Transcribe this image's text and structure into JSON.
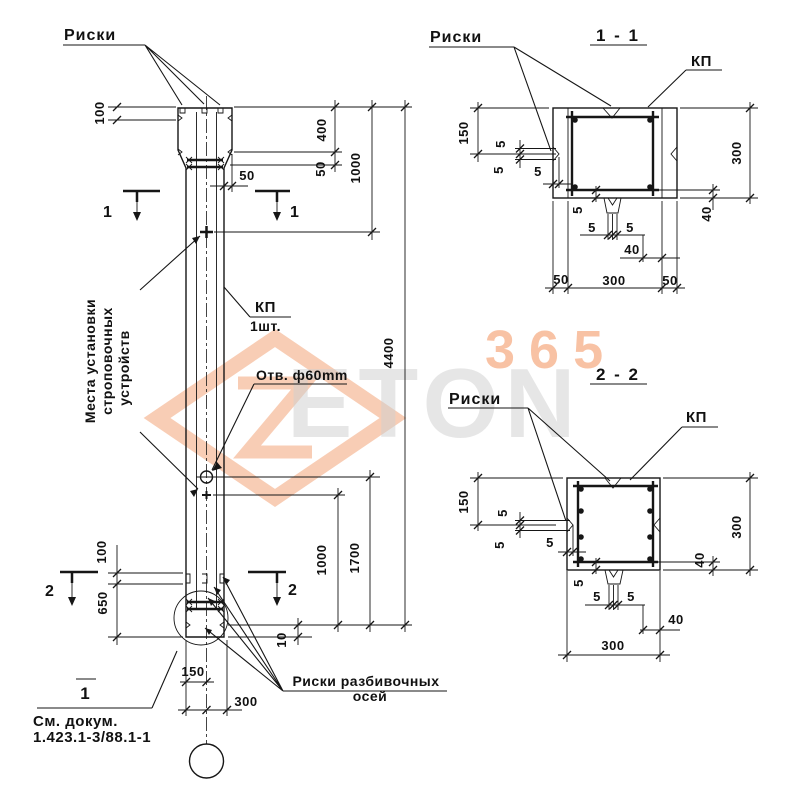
{
  "main": {
    "riski_label": "Риски",
    "kp_label": "КП",
    "kp_qty": "1шт.",
    "hole_label": "Отв. ф60mm",
    "strop_lines": [
      "Места установки",
      "строповочных",
      "устройств"
    ],
    "axis_riski_line1": "Риски разбивочных",
    "axis_riski_line2": "осей",
    "detail_mark": "1",
    "see_doc_line1": "См. докум.",
    "see_doc_line2": "1.423.1-3/88.1-1",
    "section1_mark": "1",
    "section2_mark": "2",
    "dims": {
      "d100_top": "100",
      "d400": "400",
      "d50v": "50",
      "d1000_top": "1000",
      "d4400": "4400",
      "d50h": "50",
      "d100_bot": "100",
      "d650": "650",
      "d1000_bot": "1000",
      "d1700": "1700",
      "d10": "10",
      "d150": "150",
      "d300": "300"
    }
  },
  "s11": {
    "title": "1 - 1",
    "riski": "Риски",
    "kp": "КП",
    "dims": {
      "left150": "150",
      "n5a": "5",
      "n5b": "5",
      "n5c": "5",
      "right300": "300",
      "r40": "40",
      "b5a": "5",
      "b5b": "5",
      "b5c": "5",
      "b40": "40",
      "c50l": "50",
      "c300": "300",
      "c50r": "50"
    }
  },
  "s22": {
    "title": "2 - 2",
    "riski": "Риски",
    "kp": "КП",
    "dims": {
      "left150": "150",
      "n5a": "5",
      "n5b": "5",
      "n5c": "5",
      "right300": "300",
      "r40": "40",
      "b5a": "5",
      "b5b": "5",
      "b5c": "5",
      "b40": "40",
      "c300": "300"
    }
  },
  "watermark": {
    "number": "365",
    "name": "ETON",
    "accent_color": "#f2874b",
    "gray_color": "#cfcfcf"
  }
}
